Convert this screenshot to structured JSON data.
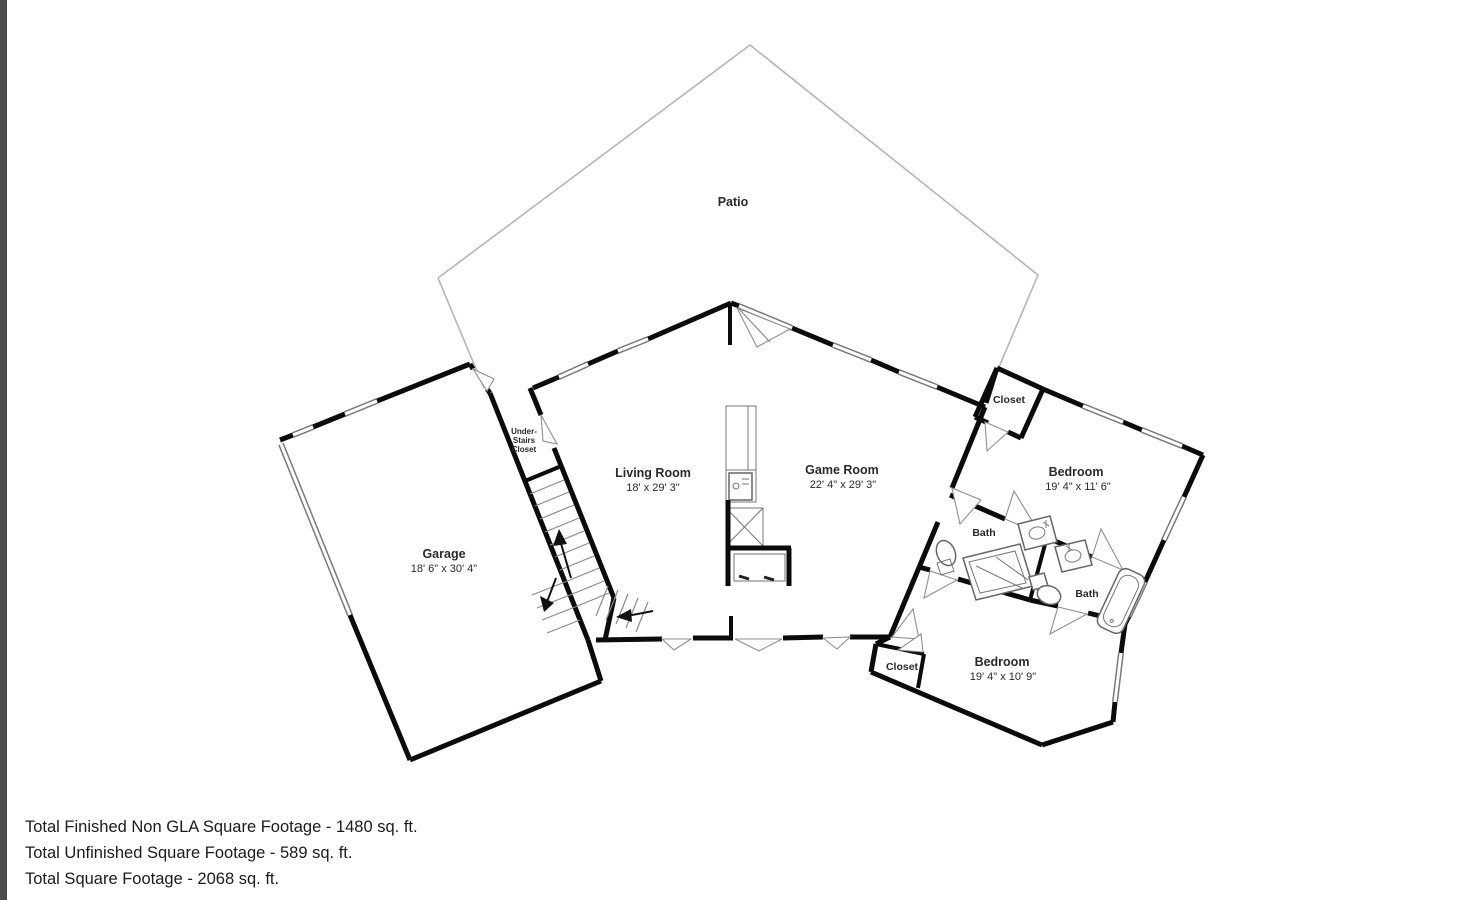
{
  "rooms": {
    "patio": "Patio",
    "living_room": {
      "name": "Living Room",
      "dims": "18' x 29' 3\""
    },
    "game_room": {
      "name": "Game Room",
      "dims": "22' 4\" x 29' 3\""
    },
    "garage": {
      "name": "Garage",
      "dims": "18' 6\" x 30' 4\""
    },
    "under_stairs_closet": [
      "Under-",
      "Stairs",
      "Closet"
    ],
    "closet_upper": "Closet",
    "bedroom_upper": {
      "name": "Bedroom",
      "dims": "19' 4\" x 11' 6\""
    },
    "bath_main": "Bath",
    "bath_second": "Bath",
    "closet_lower": "Closet",
    "bedroom_lower": {
      "name": "Bedroom",
      "dims": "19' 4\" x 10' 9\""
    }
  },
  "footer": {
    "lines": [
      "Total Finished Non GLA Square Footage - 1480 sq. ft.",
      "Total Unfinished Square Footage - 589 sq. ft.",
      "Total Square Footage - 2068 sq. ft."
    ]
  },
  "colors": {
    "wall": "#0b0b0b",
    "left_bar": "#4c4c4c",
    "patio_line": "#b5b5b5",
    "text": "#1b1b1b"
  }
}
